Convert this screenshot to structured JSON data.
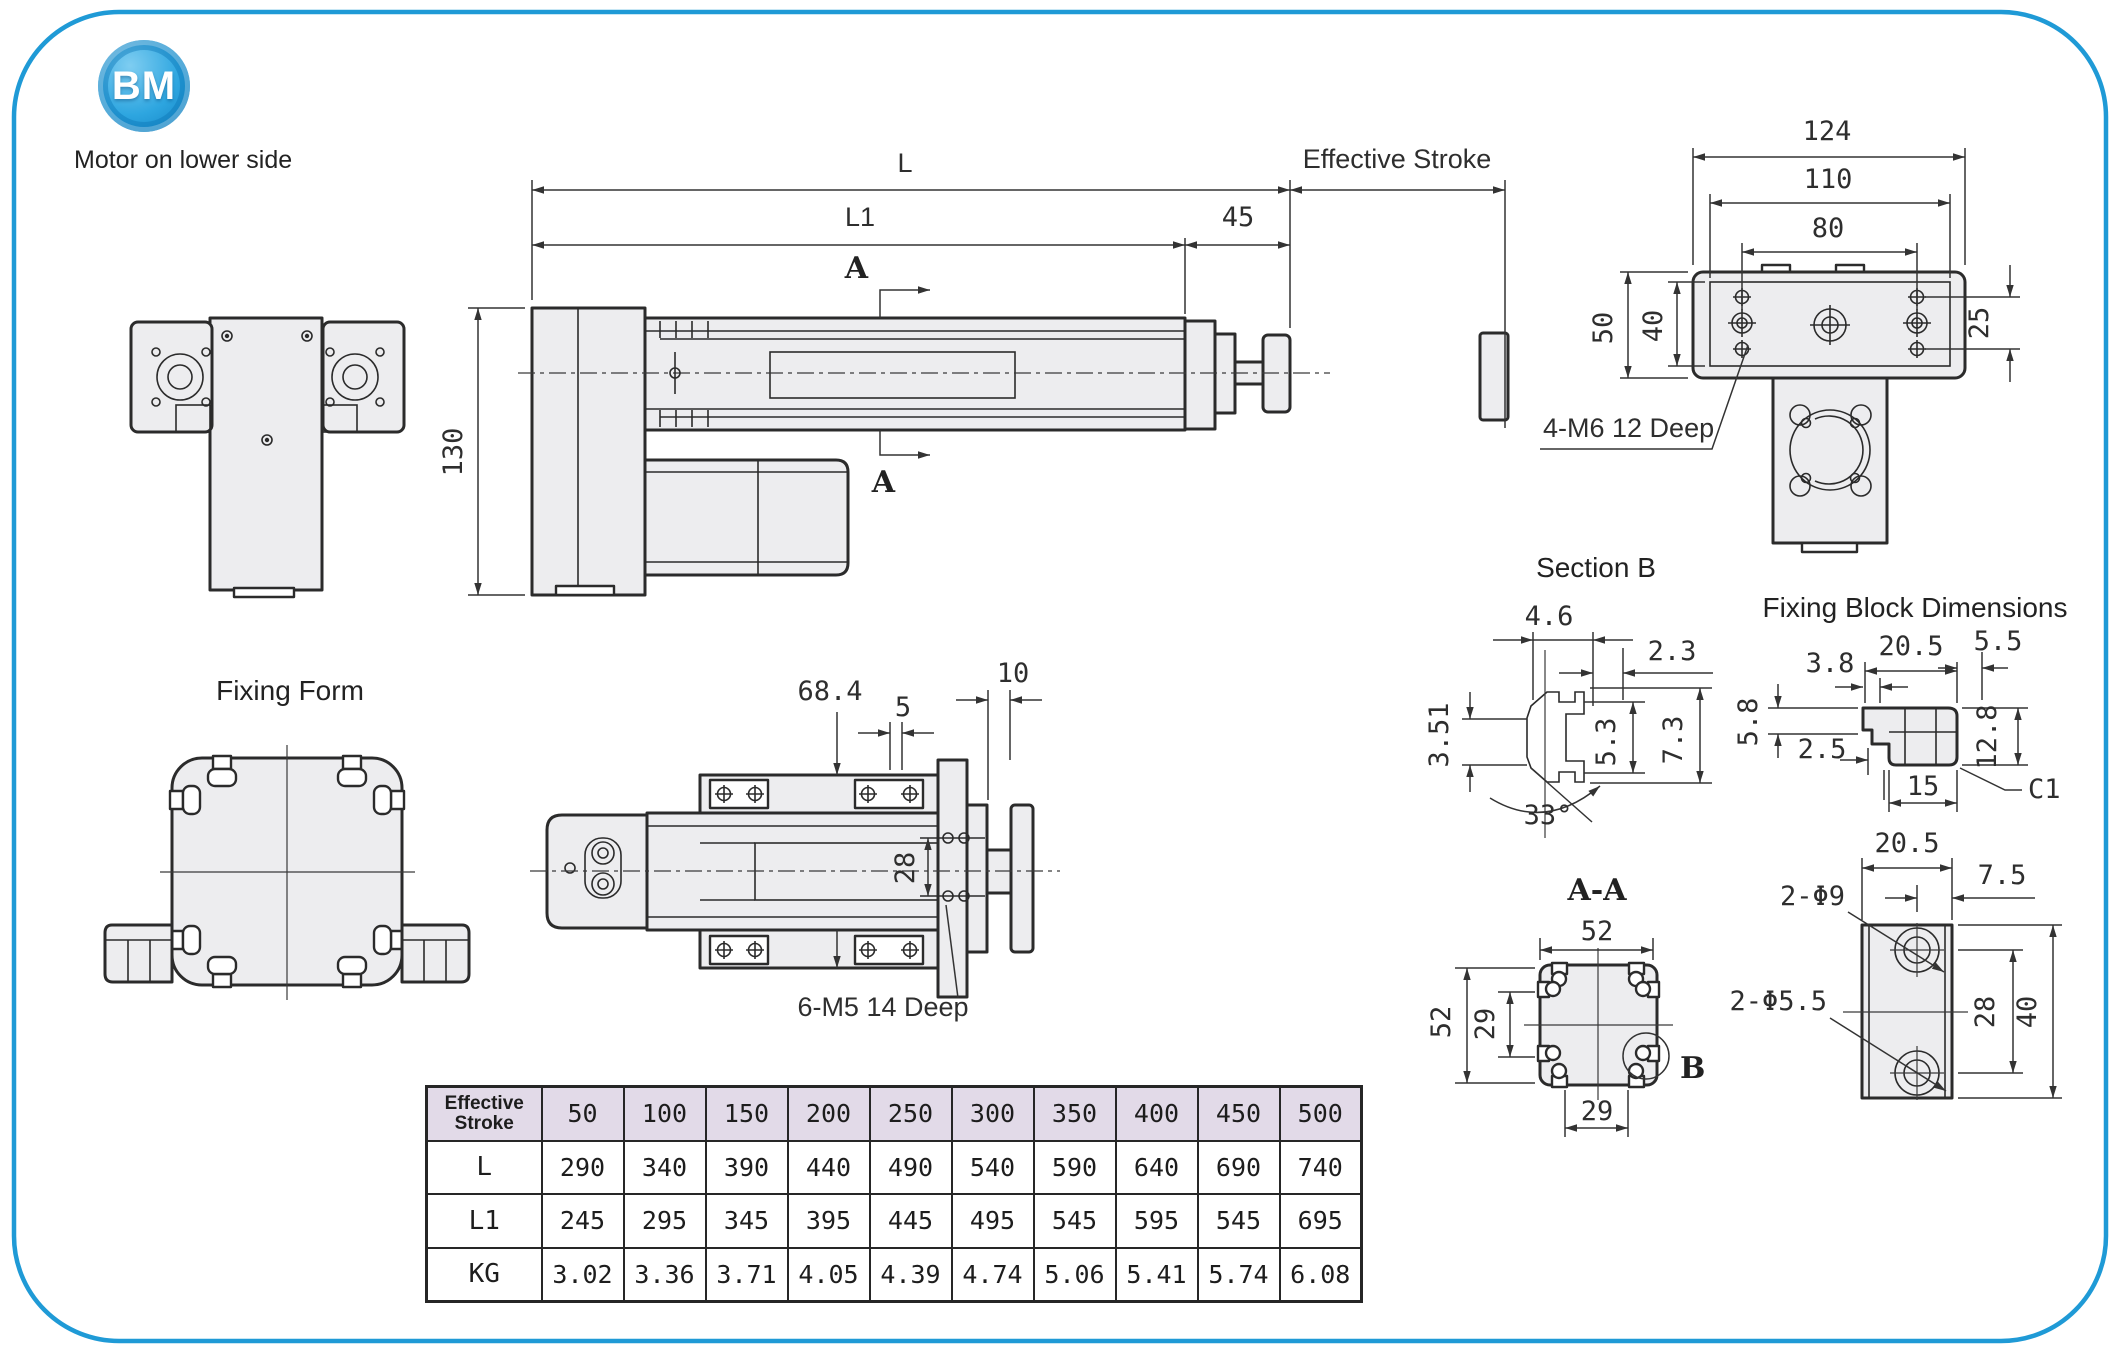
{
  "page": {
    "logo": "BM",
    "caption": "Motor on lower side",
    "fixing_form_label": "Fixing Form"
  },
  "colors": {
    "accent_blue": "#1f9ad6",
    "line": "#2b2b2b",
    "part_fill": "#ededef",
    "table_header_bg": "#e2dae8"
  },
  "side_view": {
    "dim_L": "L",
    "dim_L1": "L1",
    "dim_45": "45",
    "dim_130": "130",
    "effective_stroke_label": "Effective Stroke",
    "section_arrow_top": "A",
    "section_arrow_bottom": "A"
  },
  "end_view": {
    "dim_124": "124",
    "dim_110": "110",
    "dim_80": "80",
    "dim_50": "50",
    "dim_40": "40",
    "dim_25": "25",
    "thread_note": "4-M6  12 Deep"
  },
  "top_view": {
    "dim_68_4": "68.4",
    "dim_5": "5",
    "dim_10": "10",
    "dim_28": "28",
    "thread_note": "6-M5  14 Deep"
  },
  "section_b": {
    "title": "Section B",
    "dim_4_6": "4.6",
    "dim_2_3": "2.3",
    "dim_3_51": "3.51",
    "dim_5_3": "5.3",
    "dim_7_3": "7.3",
    "dim_angle": "33°"
  },
  "section_aa": {
    "title": "A-A",
    "dim_52_top": "52",
    "dim_52_left": "52",
    "dim_29_left": "29",
    "dim_29_bottom": "29",
    "detail_label": "B"
  },
  "fixing_block": {
    "title": "Fixing Block Dimensions",
    "dim_20_5": "20.5",
    "dim_3_8": "3.8",
    "dim_5_5": "5.5",
    "dim_5_8": "5.8",
    "dim_2_5": "2.5",
    "dim_12_8": "12.8",
    "dim_15": "15",
    "chamfer": "C1"
  },
  "fixing_block_face": {
    "dim_20_5": "20.5",
    "dim_7_5": "7.5",
    "holes_large": "2-Φ9",
    "holes_small": "2-Φ5.5",
    "dim_28": "28",
    "dim_40": "40"
  },
  "table": {
    "header_label": "Effective Stroke",
    "strokes": [
      "50",
      "100",
      "150",
      "200",
      "250",
      "300",
      "350",
      "400",
      "450",
      "500"
    ],
    "rows": [
      {
        "label": "L",
        "values": [
          "290",
          "340",
          "390",
          "440",
          "490",
          "540",
          "590",
          "640",
          "690",
          "740"
        ]
      },
      {
        "label": "L1",
        "values": [
          "245",
          "295",
          "345",
          "395",
          "445",
          "495",
          "545",
          "595",
          "545",
          "695"
        ]
      },
      {
        "label": "KG",
        "values": [
          "3.02",
          "3.36",
          "3.71",
          "4.05",
          "4.39",
          "4.74",
          "5.06",
          "5.41",
          "5.74",
          "6.08"
        ]
      }
    ]
  }
}
